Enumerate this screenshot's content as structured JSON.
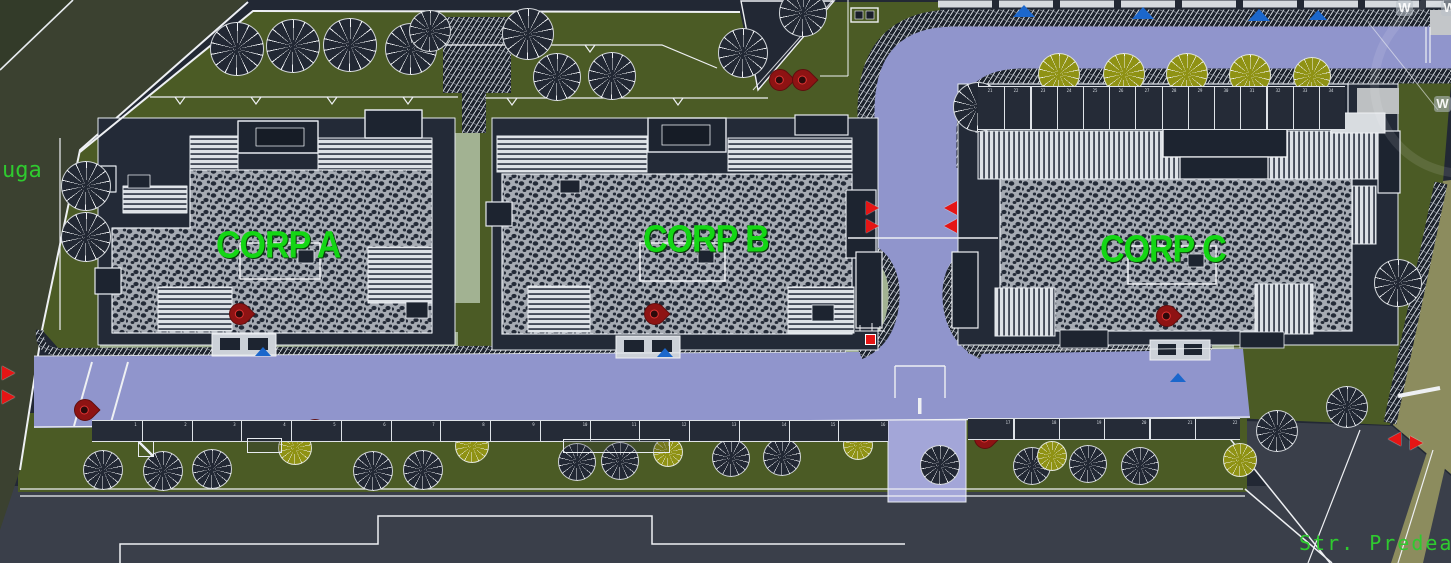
{
  "scene": {
    "width": 1451,
    "height": 563,
    "type": "cad-site-plan"
  },
  "labels": {
    "building_a": "CORP A",
    "building_b": "CORP B",
    "building_c": "CORP C",
    "street_left_partial": "uga",
    "street_bottom": "Str. Predeal",
    "watermark_letter": "W"
  },
  "colors": {
    "background": "#222834",
    "road_purple": "#9095cc",
    "driveway_purple": "#a3a6d8",
    "lawn_green": "#4b5b25",
    "sage_green": "#a2b292",
    "street_gray": "#3a3f4a",
    "olive_road": "#3b4130",
    "khaki_strip": "#8c8c5e",
    "label_green": "#14d614",
    "street_text_green": "#2fca2f",
    "pin_red": "#8e1313",
    "marker_red": "#e51515",
    "marker_blue": "#1b67cc",
    "tree_olive": "#8f9214",
    "hatch_dark": "#1d232d",
    "stripe_light": "#dde1e6",
    "pebble_field": "#a6abb3"
  },
  "trees": [
    {
      "x": 237,
      "y": 49,
      "r": 27,
      "v": "dark"
    },
    {
      "x": 293,
      "y": 46,
      "r": 27,
      "v": "dark"
    },
    {
      "x": 350,
      "y": 45,
      "r": 27,
      "v": "dark"
    },
    {
      "x": 411,
      "y": 49,
      "r": 26,
      "v": "dark"
    },
    {
      "x": 430,
      "y": 31,
      "r": 21,
      "v": "dark"
    },
    {
      "x": 528,
      "y": 34,
      "r": 26,
      "v": "dark"
    },
    {
      "x": 557,
      "y": 77,
      "r": 24,
      "v": "dark"
    },
    {
      "x": 612,
      "y": 76,
      "r": 24,
      "v": "dark"
    },
    {
      "x": 743,
      "y": 53,
      "r": 25,
      "v": "dark"
    },
    {
      "x": 803,
      "y": 13,
      "r": 24,
      "v": "dark"
    },
    {
      "x": 86,
      "y": 186,
      "r": 25,
      "v": "dark"
    },
    {
      "x": 86,
      "y": 237,
      "r": 25,
      "v": "dark"
    },
    {
      "x": 978,
      "y": 107,
      "r": 25,
      "v": "dark"
    },
    {
      "x": 1398,
      "y": 283,
      "r": 24,
      "v": "dark"
    },
    {
      "x": 1347,
      "y": 407,
      "r": 21,
      "v": "dark"
    },
    {
      "x": 1277,
      "y": 431,
      "r": 21,
      "v": "dark"
    },
    {
      "x": 1059,
      "y": 74,
      "r": 21,
      "v": "olive"
    },
    {
      "x": 1124,
      "y": 74,
      "r": 21,
      "v": "olive"
    },
    {
      "x": 1187,
      "y": 74,
      "r": 21,
      "v": "olive"
    },
    {
      "x": 1250,
      "y": 75,
      "r": 21,
      "v": "olive"
    },
    {
      "x": 1312,
      "y": 76,
      "r": 19,
      "v": "olive"
    },
    {
      "x": 103,
      "y": 470,
      "r": 20,
      "v": "dark"
    },
    {
      "x": 163,
      "y": 471,
      "r": 20,
      "v": "dark"
    },
    {
      "x": 212,
      "y": 469,
      "r": 20,
      "v": "dark"
    },
    {
      "x": 373,
      "y": 471,
      "r": 20,
      "v": "dark"
    },
    {
      "x": 423,
      "y": 470,
      "r": 20,
      "v": "dark"
    },
    {
      "x": 577,
      "y": 462,
      "r": 19,
      "v": "dark"
    },
    {
      "x": 620,
      "y": 461,
      "r": 19,
      "v": "dark"
    },
    {
      "x": 731,
      "y": 458,
      "r": 19,
      "v": "dark"
    },
    {
      "x": 782,
      "y": 457,
      "r": 19,
      "v": "dark"
    },
    {
      "x": 940,
      "y": 465,
      "r": 20,
      "v": "dark"
    },
    {
      "x": 1032,
      "y": 466,
      "r": 19,
      "v": "dark"
    },
    {
      "x": 1088,
      "y": 464,
      "r": 19,
      "v": "dark"
    },
    {
      "x": 1140,
      "y": 466,
      "r": 19,
      "v": "dark"
    },
    {
      "x": 295,
      "y": 448,
      "r": 17,
      "v": "olive"
    },
    {
      "x": 472,
      "y": 446,
      "r": 17,
      "v": "olive"
    },
    {
      "x": 668,
      "y": 452,
      "r": 15,
      "v": "olive"
    },
    {
      "x": 858,
      "y": 445,
      "r": 15,
      "v": "olive"
    },
    {
      "x": 1052,
      "y": 456,
      "r": 15,
      "v": "olive"
    },
    {
      "x": 1240,
      "y": 460,
      "r": 17,
      "v": "olive"
    }
  ],
  "pins": [
    {
      "x": 780,
      "y": 80
    },
    {
      "x": 803,
      "y": 80
    },
    {
      "x": 240,
      "y": 314
    },
    {
      "x": 655,
      "y": 314
    },
    {
      "x": 1167,
      "y": 316
    },
    {
      "x": 85,
      "y": 410
    },
    {
      "x": 315,
      "y": 430
    },
    {
      "x": 985,
      "y": 438
    }
  ],
  "red_triangles": [
    {
      "x": 2,
      "y": 366,
      "dir": "right"
    },
    {
      "x": 2,
      "y": 390,
      "dir": "right"
    },
    {
      "x": 866,
      "y": 201,
      "dir": "right"
    },
    {
      "x": 866,
      "y": 219,
      "dir": "right"
    },
    {
      "x": 944,
      "y": 201,
      "dir": "left"
    },
    {
      "x": 944,
      "y": 219,
      "dir": "left"
    },
    {
      "x": 1388,
      "y": 432,
      "dir": "left"
    },
    {
      "x": 1410,
      "y": 436,
      "dir": "right"
    }
  ],
  "red_squares": [
    {
      "x": 865,
      "y": 334,
      "s": 9
    }
  ],
  "blue_markers": [
    {
      "x": 1024,
      "y": 5,
      "w": 22,
      "h": 12
    },
    {
      "x": 1143,
      "y": 7,
      "w": 22,
      "h": 12
    },
    {
      "x": 1259,
      "y": 9,
      "w": 22,
      "h": 12
    },
    {
      "x": 1318,
      "y": 10,
      "w": 18,
      "h": 10
    },
    {
      "x": 263,
      "y": 347,
      "w": 16,
      "h": 9
    },
    {
      "x": 665,
      "y": 348,
      "w": 16,
      "h": 9
    },
    {
      "x": 1178,
      "y": 373,
      "w": 16,
      "h": 9
    }
  ],
  "watermarks": [
    {
      "x": 1396,
      "y": 0
    },
    {
      "x": 1441,
      "y": 0
    },
    {
      "x": 1434,
      "y": 96
    }
  ],
  "parking_sections": [
    {
      "x": 92,
      "y": 420,
      "w": 796,
      "h": 22,
      "count": 16,
      "num_side": "right",
      "numbers": [
        "1",
        "2",
        "3",
        "4",
        "5",
        "6",
        "7",
        "8",
        "9",
        "10",
        "11",
        "12",
        "13",
        "14",
        "15",
        "16"
      ]
    },
    {
      "x": 968,
      "y": 418,
      "w": 272,
      "h": 22,
      "count": 6,
      "num_side": "right",
      "numbers": [
        "17",
        "18",
        "19",
        "20",
        "21",
        "22"
      ]
    },
    {
      "x": 978,
      "y": 86,
      "w": 367,
      "h": 44,
      "count": 14,
      "num_side": "top",
      "numbers": [
        "21",
        "22",
        "23",
        "24",
        "25",
        "26",
        "27",
        "28",
        "29",
        "30",
        "31",
        "32",
        "33",
        "34"
      ]
    }
  ],
  "furniture": [
    {
      "t": "bench",
      "x": 247,
      "y": 438,
      "w": 35,
      "h": 15
    },
    {
      "t": "bench",
      "x": 563,
      "y": 439,
      "w": 107,
      "h": 14
    },
    {
      "t": "sqx",
      "x": 138,
      "y": 441,
      "w": 16,
      "h": 16
    }
  ]
}
